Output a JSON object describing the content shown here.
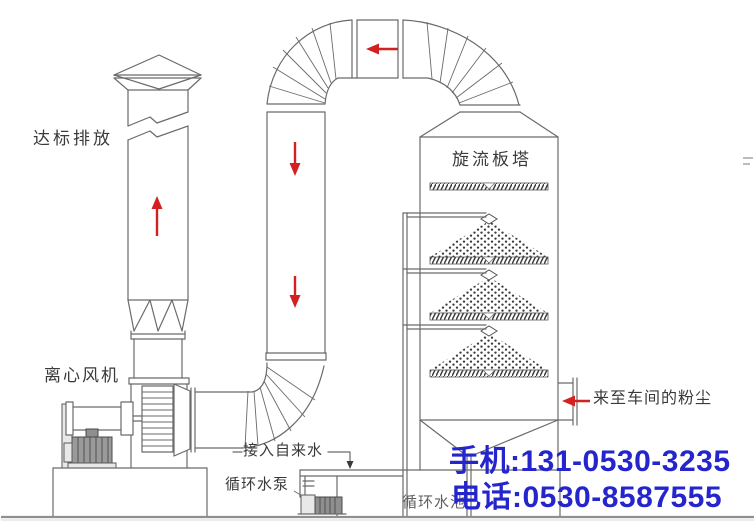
{
  "diagram": {
    "labels": {
      "discharge": "达标排放",
      "centrifugal_fan": "离心风机",
      "swirl_plate_tower": "旋流板塔",
      "tap_water_inlet": "接入自来水",
      "circulating_pump": "循环水泵",
      "circulating_pool": "循环水池",
      "dust_from_workshop": "来至车间的粉尘"
    },
    "contact": {
      "mobile": "手机:131-0530-3235",
      "telephone": "电话:0530-8587555"
    },
    "colors": {
      "flow_arrow_red": "#d32020",
      "line_gray": "#6a6a6a",
      "label_ink": "#3a3a3a",
      "contact_blue": "#2525cd",
      "pool_label_gray": "#606060"
    }
  }
}
